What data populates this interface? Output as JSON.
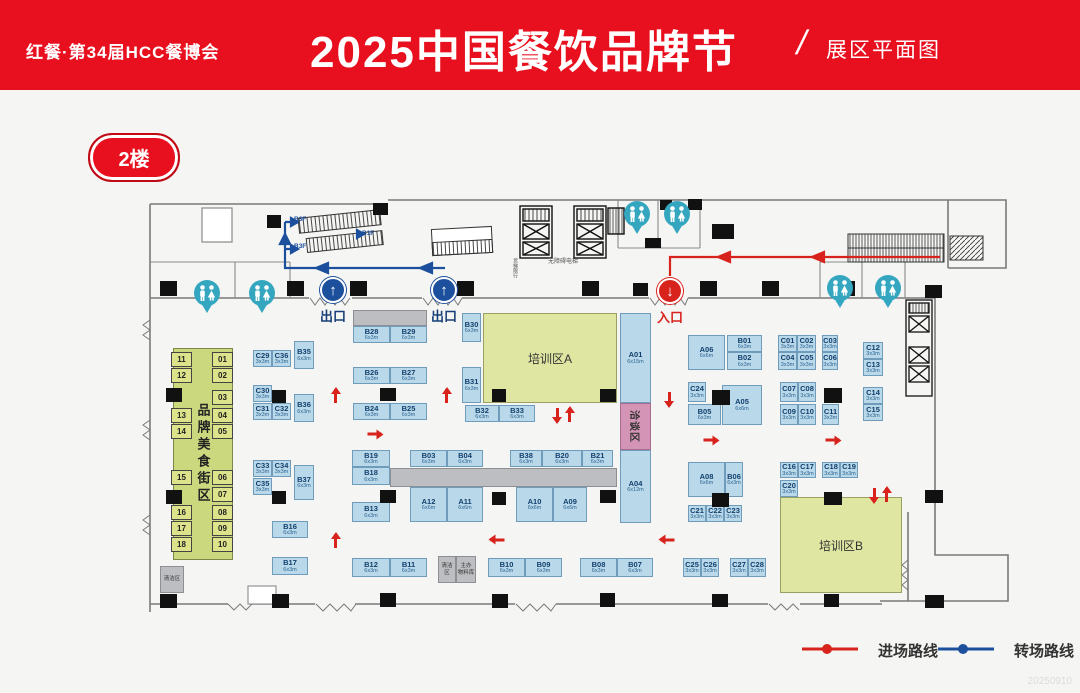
{
  "header": {
    "brand": "红餐·第34届HCC餐博会",
    "title": "2025中国餐饮品牌节",
    "slash": "/",
    "subtitle": "展区平面图"
  },
  "floor_badge": "2楼",
  "legend": {
    "entry": {
      "label": "进场路线",
      "color": "#d8231d"
    },
    "transfer": {
      "label": "转场路线",
      "color": "#1c4f9c"
    }
  },
  "watermark": "20250910",
  "floorplan": {
    "colors": {
      "booth_fill": "#b9d9ea",
      "booth_border": "#6f9cba",
      "training_zone": "#dfe6a2",
      "food_street": "#ccd87e",
      "meeting_zone": "#d494b6",
      "gray_block": "#bdbec1",
      "restroom": "#35a6bf",
      "entry_route": "#d8231d",
      "transfer_route": "#1c4f9c"
    },
    "zones": [
      {
        "label": "品牌美食街区",
        "type": "street",
        "x": 173,
        "y": 348,
        "w": 60,
        "h": 212
      },
      {
        "label": "培训区A",
        "type": "train",
        "x": 483,
        "y": 313,
        "w": 134,
        "h": 90
      },
      {
        "label": "培训区B",
        "type": "train",
        "x": 780,
        "y": 497,
        "w": 122,
        "h": 96
      },
      {
        "label": "洽谈区",
        "type": "meet",
        "x": 620,
        "y": 403,
        "w": 31,
        "h": 47
      }
    ],
    "booths": [
      [
        "C29",
        "3x3m",
        253,
        350,
        19,
        17
      ],
      [
        "C36",
        "3x3m",
        272,
        350,
        19,
        17
      ],
      [
        "B35",
        "6x3m",
        294,
        341,
        20,
        28
      ],
      [
        "C30",
        "3x3m",
        253,
        385,
        19,
        17
      ],
      [
        "C31",
        "3x3m",
        253,
        403,
        19,
        17
      ],
      [
        "C32",
        "3x3m",
        272,
        403,
        19,
        17
      ],
      [
        "B36",
        "6x3m",
        294,
        394,
        20,
        28
      ],
      [
        "C33",
        "3x3m",
        253,
        460,
        19,
        17
      ],
      [
        "C34",
        "3x3m",
        272,
        460,
        19,
        17
      ],
      [
        "C35",
        "3x3m",
        253,
        478,
        19,
        17
      ],
      [
        "B37",
        "6x3m",
        294,
        465,
        20,
        35
      ],
      [
        "B16",
        "6x3m",
        272,
        521,
        36,
        17
      ],
      [
        "B17",
        "6x3m",
        272,
        557,
        36,
        18
      ],
      [
        "B28",
        "6x3m",
        353,
        326,
        37,
        17
      ],
      [
        "B29",
        "6x3m",
        390,
        326,
        37,
        17
      ],
      [
        "B26",
        "6x3m",
        353,
        367,
        37,
        17
      ],
      [
        "B27",
        "6x3m",
        390,
        367,
        37,
        17
      ],
      [
        "B24",
        "6x3m",
        353,
        403,
        37,
        17
      ],
      [
        "B25",
        "6x3m",
        390,
        403,
        37,
        17
      ],
      [
        "B30",
        "6x3m",
        462,
        313,
        19,
        29
      ],
      [
        "B31",
        "6x3m",
        462,
        367,
        19,
        36
      ],
      [
        "B32",
        "6x3m",
        465,
        405,
        34,
        17
      ],
      [
        "B33",
        "6x3m",
        499,
        405,
        36,
        17
      ],
      [
        "A01",
        "6x15m",
        620,
        313,
        31,
        90
      ],
      [
        "A04",
        "6x12m",
        620,
        450,
        31,
        73
      ],
      [
        "B19",
        "6x3m",
        352,
        450,
        38,
        17
      ],
      [
        "B18",
        "6x3m",
        352,
        467,
        38,
        18
      ],
      [
        "B13",
        "6x3m",
        352,
        502,
        38,
        20
      ],
      [
        "B03",
        "6x3m",
        410,
        450,
        37,
        17
      ],
      [
        "B04",
        "6x3m",
        447,
        450,
        36,
        17
      ],
      [
        "B38",
        "6x3m",
        510,
        450,
        32,
        17
      ],
      [
        "B20",
        "6x3m",
        542,
        450,
        40,
        17
      ],
      [
        "B21",
        "6x3m",
        582,
        450,
        31,
        17
      ],
      [
        "A12",
        "6x6m",
        410,
        487,
        37,
        35
      ],
      [
        "A11",
        "6x6m",
        447,
        487,
        36,
        35
      ],
      [
        "A10",
        "6x6m",
        516,
        487,
        37,
        35
      ],
      [
        "A09",
        "6x6m",
        553,
        487,
        34,
        35
      ],
      [
        "B12",
        "6x3m",
        352,
        558,
        38,
        19
      ],
      [
        "B11",
        "6x3m",
        390,
        558,
        37,
        19
      ],
      [
        "B10",
        "6x3m",
        488,
        558,
        37,
        19
      ],
      [
        "B09",
        "6x3m",
        525,
        558,
        37,
        19
      ],
      [
        "B08",
        "6x3m",
        580,
        558,
        37,
        19
      ],
      [
        "B07",
        "6x3m",
        617,
        558,
        36,
        19
      ],
      [
        "A06",
        "6x6m",
        688,
        335,
        37,
        35
      ],
      [
        "B01",
        "6x3m",
        727,
        335,
        35,
        17
      ],
      [
        "B02",
        "6x3m",
        727,
        352,
        35,
        18
      ],
      [
        "C01",
        "3x3m",
        778,
        335,
        19,
        17
      ],
      [
        "C02",
        "3x3m",
        797,
        335,
        19,
        17
      ],
      [
        "C03",
        "3x3m",
        822,
        335,
        16,
        17
      ],
      [
        "C04",
        "3x3m",
        778,
        352,
        19,
        18
      ],
      [
        "C05",
        "3x3m",
        797,
        352,
        19,
        18
      ],
      [
        "C06",
        "3x3m",
        822,
        352,
        16,
        18
      ],
      [
        "C12",
        "3x3m",
        863,
        342,
        20,
        17
      ],
      [
        "C13",
        "3x3m",
        863,
        359,
        20,
        17
      ],
      [
        "C24",
        "3x3m",
        688,
        382,
        18,
        20
      ],
      [
        "B05",
        "6x3m",
        688,
        404,
        33,
        21
      ],
      [
        "A05",
        "6x6m",
        722,
        385,
        40,
        40
      ],
      [
        "C07",
        "3x3m",
        780,
        382,
        18,
        20
      ],
      [
        "C08",
        "3x3m",
        798,
        382,
        18,
        20
      ],
      [
        "C09",
        "3x3m",
        780,
        404,
        18,
        21
      ],
      [
        "C10",
        "3x3m",
        798,
        404,
        18,
        21
      ],
      [
        "C11",
        "3x3m",
        822,
        404,
        17,
        21
      ],
      [
        "C14",
        "3x3m",
        863,
        387,
        20,
        17
      ],
      [
        "C15",
        "3x3m",
        863,
        404,
        20,
        17
      ],
      [
        "A08",
        "6x6m",
        688,
        462,
        37,
        35
      ],
      [
        "B06",
        "6x3m",
        725,
        462,
        18,
        35
      ],
      [
        "C21",
        "3x3m",
        688,
        505,
        18,
        17
      ],
      [
        "C22",
        "3x3m",
        706,
        505,
        18,
        17
      ],
      [
        "C23",
        "3x3m",
        724,
        505,
        18,
        17
      ],
      [
        "C16",
        "3x3m",
        780,
        462,
        18,
        16
      ],
      [
        "C17",
        "3x3m",
        798,
        462,
        18,
        16
      ],
      [
        "C18",
        "3x3m",
        822,
        462,
        18,
        16
      ],
      [
        "C19",
        "3x3m",
        840,
        462,
        18,
        16
      ],
      [
        "C20",
        "3x3m",
        780,
        480,
        18,
        17
      ],
      [
        "C25",
        "3x3m",
        683,
        558,
        18,
        19
      ],
      [
        "C26",
        "3x3m",
        701,
        558,
        18,
        19
      ],
      [
        "C27",
        "3x3m",
        730,
        558,
        18,
        19
      ],
      [
        "C28",
        "3x3m",
        748,
        558,
        18,
        19
      ]
    ],
    "street_numbers": [
      [
        "11",
        171,
        352
      ],
      [
        "12",
        171,
        368
      ],
      [
        "13",
        171,
        408
      ],
      [
        "14",
        171,
        424
      ],
      [
        "15",
        171,
        470
      ],
      [
        "16",
        171,
        505
      ],
      [
        "17",
        171,
        521
      ],
      [
        "18",
        171,
        537
      ],
      [
        "01",
        212,
        352
      ],
      [
        "02",
        212,
        368
      ],
      [
        "03",
        212,
        390
      ],
      [
        "04",
        212,
        408
      ],
      [
        "05",
        212,
        424
      ],
      [
        "06",
        212,
        470
      ],
      [
        "07",
        212,
        487
      ],
      [
        "08",
        212,
        505
      ],
      [
        "09",
        212,
        521
      ],
      [
        "10",
        212,
        537
      ]
    ],
    "gray_blocks": [
      {
        "x": 353,
        "y": 310,
        "w": 74,
        "h": 16,
        "label": ""
      },
      {
        "x": 390,
        "y": 468,
        "w": 227,
        "h": 19,
        "label": ""
      },
      {
        "x": 438,
        "y": 556,
        "w": 18,
        "h": 27,
        "label": "清洁区"
      },
      {
        "x": 456,
        "y": 556,
        "w": 20,
        "h": 27,
        "label": "主办\n物料库"
      },
      {
        "x": 160,
        "y": 566,
        "w": 24,
        "h": 27,
        "label": "清洁区"
      }
    ],
    "pillars": [
      [
        160,
        281,
        17,
        15
      ],
      [
        287,
        281,
        17,
        15
      ],
      [
        350,
        281,
        17,
        15
      ],
      [
        457,
        281,
        17,
        15
      ],
      [
        582,
        281,
        17,
        15
      ],
      [
        633,
        283,
        15,
        13
      ],
      [
        700,
        281,
        17,
        15
      ],
      [
        762,
        281,
        17,
        15
      ],
      [
        838,
        281,
        17,
        15
      ],
      [
        925,
        285,
        17,
        13
      ],
      [
        166,
        388,
        16,
        14
      ],
      [
        272,
        390,
        14,
        13
      ],
      [
        380,
        388,
        16,
        13
      ],
      [
        492,
        389,
        14,
        13
      ],
      [
        600,
        389,
        16,
        13
      ],
      [
        712,
        390,
        18,
        15
      ],
      [
        824,
        388,
        18,
        15
      ],
      [
        166,
        490,
        16,
        14
      ],
      [
        272,
        491,
        14,
        13
      ],
      [
        380,
        490,
        16,
        13
      ],
      [
        492,
        492,
        14,
        13
      ],
      [
        600,
        490,
        16,
        13
      ],
      [
        712,
        493,
        17,
        14
      ],
      [
        824,
        492,
        18,
        13
      ],
      [
        925,
        490,
        18,
        13
      ],
      [
        160,
        594,
        17,
        14
      ],
      [
        272,
        594,
        17,
        14
      ],
      [
        380,
        593,
        16,
        14
      ],
      [
        492,
        594,
        16,
        14
      ],
      [
        600,
        593,
        15,
        14
      ],
      [
        712,
        594,
        16,
        13
      ],
      [
        824,
        594,
        15,
        13
      ],
      [
        925,
        595,
        19,
        13
      ],
      [
        267,
        215,
        14,
        13
      ],
      [
        373,
        203,
        15,
        12
      ],
      [
        660,
        200,
        12,
        10
      ],
      [
        688,
        199,
        14,
        11
      ],
      [
        645,
        238,
        16,
        10
      ],
      [
        712,
        224,
        22,
        15
      ]
    ],
    "texts": [
      {
        "t": "B3F",
        "x": 294,
        "y": 217,
        "s": 6.5,
        "c": "#1c4f9c",
        "b": 1
      },
      {
        "t": "B1F",
        "x": 362,
        "y": 231,
        "s": 6.5,
        "c": "#1c4f9c",
        "b": 1
      },
      {
        "t": "B3F",
        "x": 294,
        "y": 244,
        "s": 6.5,
        "c": "#1c4f9c",
        "b": 1
      },
      {
        "t": "无障碍电梯",
        "x": 548,
        "y": 259,
        "s": 6,
        "c": "#555"
      },
      {
        "t": "货梯限行",
        "x": 512,
        "y": 258,
        "s": 5,
        "c": "#555",
        "v": 1
      }
    ],
    "gates": [
      {
        "variant": "exit",
        "glyph": "↑",
        "label": "出口",
        "x": 333,
        "y": 277
      },
      {
        "variant": "exit",
        "glyph": "↑",
        "label": "出口",
        "x": 444,
        "y": 277
      },
      {
        "variant": "enter",
        "glyph": "↓",
        "label": "入口",
        "x": 670,
        "y": 278
      }
    ],
    "restrooms": [
      {
        "x": 207,
        "y": 293
      },
      {
        "x": 262,
        "y": 293
      },
      {
        "x": 637,
        "y": 214
      },
      {
        "x": 677,
        "y": 214
      },
      {
        "x": 840,
        "y": 288
      },
      {
        "x": 888,
        "y": 288
      }
    ],
    "entry_arrows": [
      {
        "d": "up",
        "x": 334,
        "y": 396
      },
      {
        "d": "up",
        "x": 445,
        "y": 396
      },
      {
        "d": "up",
        "x": 334,
        "y": 541
      },
      {
        "d": "right",
        "x": 373,
        "y": 434
      },
      {
        "d": "down",
        "x": 556,
        "y": 415
      },
      {
        "d": "up",
        "x": 568,
        "y": 415
      },
      {
        "d": "down",
        "x": 668,
        "y": 399
      },
      {
        "d": "right",
        "x": 709,
        "y": 440
      },
      {
        "d": "right",
        "x": 831,
        "y": 440
      },
      {
        "d": "left",
        "x": 496,
        "y": 540
      },
      {
        "d": "left",
        "x": 666,
        "y": 540
      },
      {
        "d": "down",
        "x": 873,
        "y": 495
      },
      {
        "d": "up",
        "x": 885,
        "y": 495
      }
    ]
  }
}
